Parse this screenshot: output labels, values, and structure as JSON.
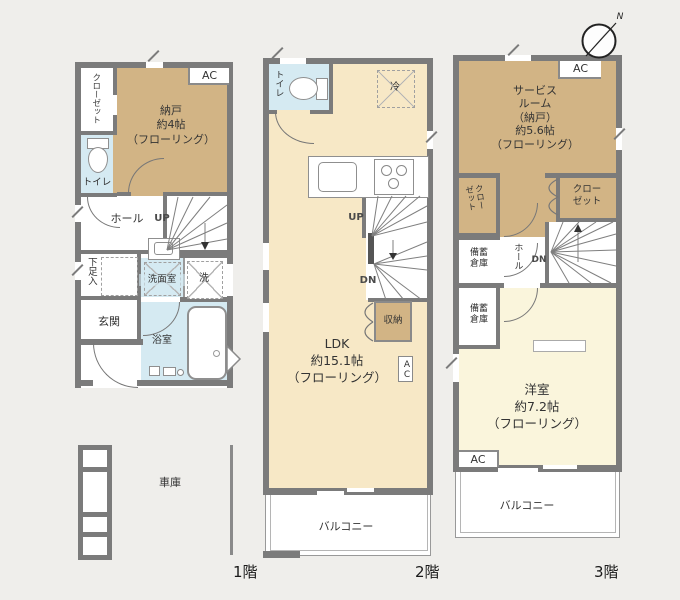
{
  "compass": {
    "north": "N"
  },
  "colors": {
    "wall": "#7b7b7b",
    "tan_room": "#d2b485",
    "cream_room": "#f7e8c6",
    "ivory_room": "#faf5dc",
    "wet_room_blue": "#d5eaf2",
    "background": "#efeeeb"
  },
  "floor1": {
    "label": "1階",
    "closet": "クローゼット",
    "nando": "納戸\n約4帖\n（フローリング）",
    "ac": "AC",
    "toilet": "トイレ",
    "hall": "ホール",
    "up": "UP",
    "shoe_storage": "下足入",
    "washroom": "洗面室",
    "washer": "洗",
    "entrance": "玄関",
    "bath": "浴室",
    "garage": "車庫"
  },
  "floor2": {
    "label": "2階",
    "toilet": "トイレ",
    "fridge": "冷",
    "up": "UP",
    "dn": "DN",
    "storage": "収納",
    "ac": "AC",
    "ldk": "LDK\n約15.1帖\n（フローリング）",
    "balcony": "バルコニー"
  },
  "floor3": {
    "label": "3階",
    "service_room": "サービス\nルーム\n（納戸）\n約5.6帖\n（フローリング）",
    "ac_top": "AC",
    "closet_left": "クロー\nゼット",
    "closet_right": "クロー\nゼット",
    "stock_storage": "備蓄\n倉庫",
    "hall": "ホール",
    "dn": "DN",
    "western_room": "洋室\n約7.2帖\n（フローリング）",
    "ac_bottom": "AC",
    "balcony": "バルコニー"
  }
}
